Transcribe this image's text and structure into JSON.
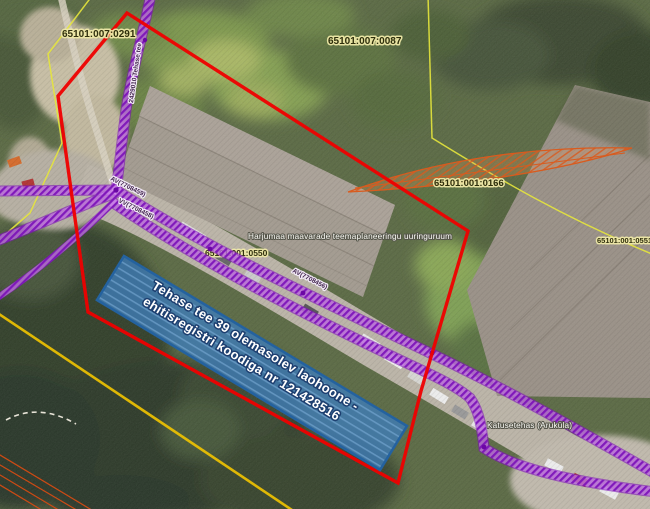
{
  "map": {
    "parcels": [
      {
        "id": "65101:007:0291"
      },
      {
        "id": "65101:007:0087"
      },
      {
        "id": "65101:001:0166"
      },
      {
        "id": "65101:001:0551"
      },
      {
        "id": "65101:001:0550"
      }
    ],
    "highlight": {
      "line1": "Tehase tee 39 olemasolev laohoone -",
      "line2": "ehitisregistri koodiga nr 121428516",
      "fill_color": "#3f7cb6",
      "border_color": "#24629f"
    },
    "annotations": {
      "planning_area": "Harjumaa maavarade teemaplaneeringu uuringuruum",
      "place_label": "Katusetehas (Aruküla)"
    },
    "utilities": [
      {
        "label": "2429010 Tehase tee"
      },
      {
        "label": "AV(7708459)"
      },
      {
        "label": "VV(7708458)"
      },
      {
        "label": "AV(7708456)"
      }
    ],
    "colors": {
      "boundary_red": "#ef0000",
      "utility_purple": "#8a12c8",
      "cadastral_yellow": "#e6e63c",
      "survey_orange": "#d95b1e"
    }
  }
}
